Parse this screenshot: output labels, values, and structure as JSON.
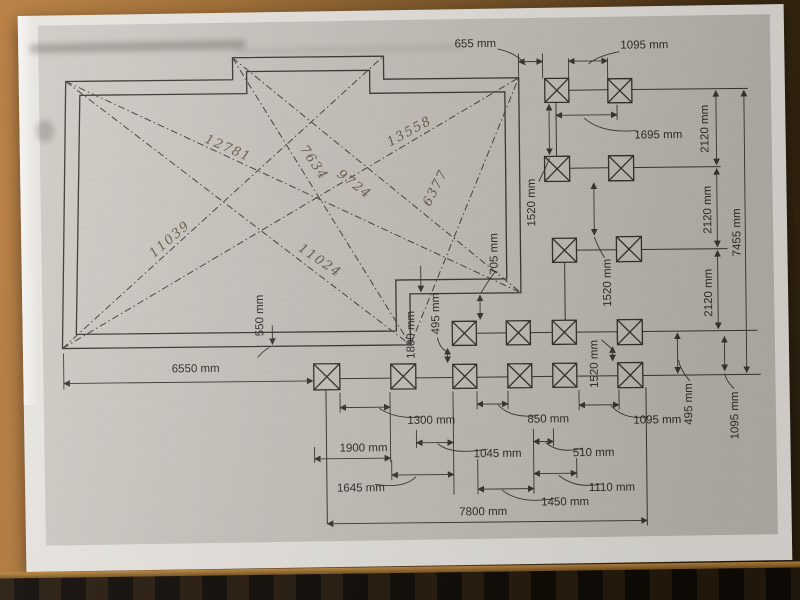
{
  "colors": {
    "paper": "#e9e6e1",
    "scan_background": "#cac5bf",
    "ink": "#3a3631",
    "pencil": "#6a5c4b",
    "wood_light": "#b5793a",
    "wood_dark": "#2f2210"
  },
  "drawing": {
    "dim_labels": [
      {
        "id": "top-655",
        "text": "655 mm"
      },
      {
        "id": "top-1095",
        "text": "1095 mm"
      },
      {
        "id": "row1-1695",
        "text": "1695 mm"
      },
      {
        "id": "right-2120-a",
        "text": "2120 mm"
      },
      {
        "id": "right-2120-b",
        "text": "2120 mm"
      },
      {
        "id": "right-2120-c",
        "text": "2120 mm"
      },
      {
        "id": "right-7455",
        "text": "7455 mm"
      },
      {
        "id": "mid-1520-a",
        "text": "1520 mm"
      },
      {
        "id": "mid-1520-b",
        "text": "1520 mm"
      },
      {
        "id": "mid-1520-c",
        "text": "1520 mm"
      },
      {
        "id": "mid-705",
        "text": "705 mm"
      },
      {
        "id": "mid-495",
        "text": "495 mm"
      },
      {
        "id": "mid-1800",
        "text": "1800 mm"
      },
      {
        "id": "left-550",
        "text": "550 mm"
      },
      {
        "id": "left-6550",
        "text": "6550 mm"
      },
      {
        "id": "right-495",
        "text": "495 mm"
      },
      {
        "id": "right-1095-v",
        "text": "1095 mm"
      },
      {
        "id": "bottom-1095",
        "text": "1095 mm"
      },
      {
        "id": "bottom-1300",
        "text": "1300 mm"
      },
      {
        "id": "bottom-850",
        "text": "850 mm"
      },
      {
        "id": "bottom-1900",
        "text": "1900 mm"
      },
      {
        "id": "bottom-1045",
        "text": "1045 mm"
      },
      {
        "id": "bottom-510",
        "text": "510 mm"
      },
      {
        "id": "bottom-1645",
        "text": "1645 mm"
      },
      {
        "id": "bottom-1110",
        "text": "1110 mm"
      },
      {
        "id": "bottom-1450",
        "text": "1450 mm"
      },
      {
        "id": "bottom-7800",
        "text": "7800 mm"
      }
    ],
    "handwritten_labels": [
      {
        "id": "diag-1",
        "text": "12781"
      },
      {
        "id": "diag-2",
        "text": "7634"
      },
      {
        "id": "diag-3",
        "text": "13558"
      },
      {
        "id": "diag-4",
        "text": "9724"
      },
      {
        "id": "diag-5",
        "text": "6377"
      },
      {
        "id": "diag-6",
        "text": "11039"
      },
      {
        "id": "diag-7",
        "text": "11024"
      }
    ]
  }
}
